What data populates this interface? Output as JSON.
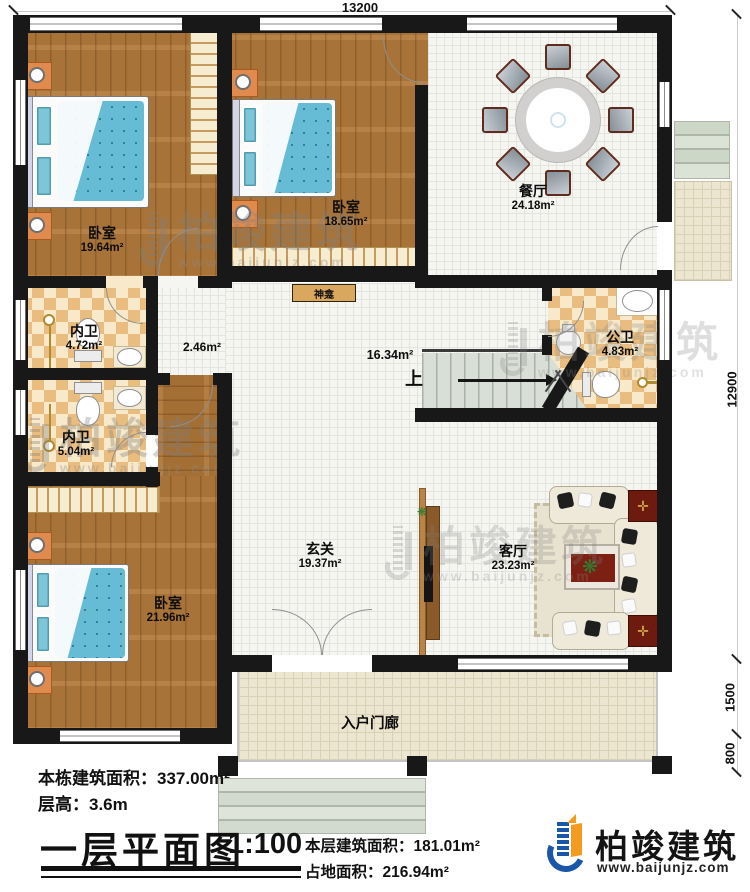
{
  "canvas": {
    "width": 750,
    "height": 892
  },
  "dimensions": {
    "width_top": "13200",
    "depth_main": "12900",
    "porch_depth": "1500",
    "steps_depth": "800"
  },
  "rooms": {
    "bedroom_tl": {
      "name": "卧室",
      "area": "19.64m²"
    },
    "bedroom_tm": {
      "name": "卧室",
      "area": "18.65m²"
    },
    "bedroom_b": {
      "name": "卧室",
      "area": "21.96m²"
    },
    "dining": {
      "name": "餐厅",
      "area": "24.18m²"
    },
    "ensuite_1": {
      "name": "内卫",
      "area": "4.72m²"
    },
    "ensuite_2": {
      "name": "内卫",
      "area": "5.04m²"
    },
    "public_bath": {
      "name": "公卫",
      "area": "4.83m²"
    },
    "foyer": {
      "name": "玄关",
      "area": "19.37m²"
    },
    "living": {
      "name": "客厅",
      "area": "23.23m²"
    },
    "porch": {
      "name": "入户门廊"
    },
    "stair_hall_area": "16.34m²",
    "corridor_area": "2.46m²",
    "shrine_label": "神龛",
    "stairs_up_label": "上"
  },
  "info": {
    "building_area": "本栋建筑面积：337.00m²",
    "floor_height": "层高：3.6m"
  },
  "title_block": {
    "title": "一层平面图",
    "scale": "1:100",
    "floor_area": "本层建筑面积：181.01m²",
    "footprint": "占地面积：216.94m²"
  },
  "brand": {
    "name": "柏竣建筑",
    "website": "www.baijunjz.com"
  },
  "watermark": {
    "name": "柏竣建筑",
    "website": "www.baijunjz.com"
  },
  "colors": {
    "wall": "#181818",
    "wood": "#b0793c",
    "tile": "#e9bd7f",
    "brand_blue": "#1b57a8",
    "brand_orange": "#f49a1e",
    "bed_blue": "#69bcd4",
    "stair_grey": "#d9ded7"
  }
}
